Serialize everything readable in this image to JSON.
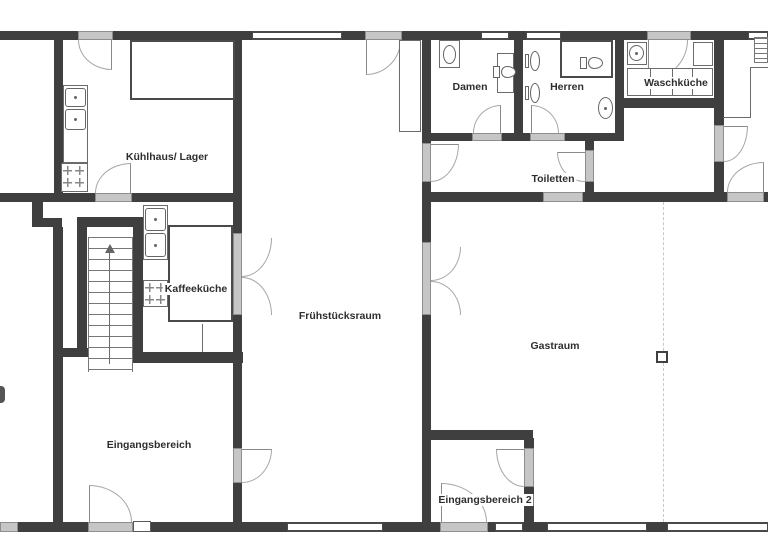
{
  "figure_type": "floor-plan",
  "palette": {
    "wall": "#3f3f3f",
    "door_sill": "#c6c6c6",
    "fixture_outline": "#6b6b6b",
    "door_arc": "#a6a6a6",
    "label_text": "#2e2e2e",
    "background": "#ffffff",
    "section_dashed_line": "#c9c9c9"
  },
  "rooms": {
    "kuehlhaus": {
      "label": "Kühlhaus/ Lager"
    },
    "kaffeekueche": {
      "label": "Kaffeeküche"
    },
    "fruehstuecksraum": {
      "label": "Frühstücksraum"
    },
    "eingangsbereich": {
      "label": "Eingangsbereich"
    },
    "damen": {
      "label": "Damen"
    },
    "herren": {
      "label": "Herren"
    },
    "waschkueche": {
      "label": "Waschküche"
    },
    "toiletten": {
      "label": "Toiletten"
    },
    "gastraum": {
      "label": "Gastraum"
    },
    "eingangsbereich2": {
      "label": "Eingangsbereich 2"
    }
  }
}
